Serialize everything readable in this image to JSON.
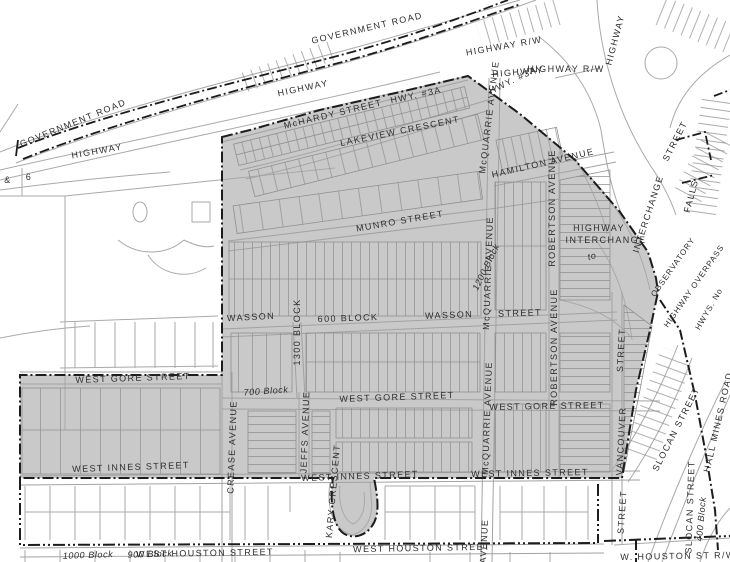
{
  "map": {
    "colors": {
      "background": "#ffffff",
      "zone_fill": "#c9c9c9",
      "boundary_line": "#1c1c1c",
      "road_line": "#a9a9a9",
      "parcel_line": "#8f8f8f",
      "label_text": "#2e2e2e"
    },
    "labels": {
      "government_road": "GOVERNMENT ROAD",
      "highway": "HIGHWAY",
      "highway_rw": "HIGHWAY  R/W",
      "hwy_3a": "HWY.  #3A",
      "ampersand": "&",
      "six": "6",
      "mchardy_street": "McHARDY STREET",
      "lakeview_crescent": "LAKEVIEW  CRESCENT",
      "hamilton_avenue": "HAMILTON  AVENUE",
      "munro_street": "MUNRO   STREET",
      "mcquarrie_avenue": "McQUARRIE  AVENUE",
      "avenue": "AVENUE",
      "robertson_avenue": "ROBERTSON  AVENUE",
      "vancouver": "VANCOUVER",
      "street": "STREET",
      "wasson": "WASSON",
      "block_600": "600  BLOCK",
      "block_1300": "1300  BLOCK",
      "block_1200": "1200 Block",
      "block_700": "700  Block",
      "block_1000": "1000  Block",
      "block_900": "900 Block",
      "block_400": "400 Block",
      "west_gore_street": "WEST  GORE  STREET",
      "west_innes_street": "WEST  INNES  STREET",
      "west_houston_street": "WEST  HOUSTON  STREET",
      "w_houston_st_rw": "W.  HOUSTON ST R/W",
      "crease_avenue": "CREASE  AVENUE",
      "jeffs_avenue": "JEFFS  AVENUE",
      "kary_crescent": "KARY CRESCENT",
      "slocan_street": "SLOCAN  STREET",
      "hall_mines_road": "HALL  MINES  ROAD",
      "falls": "FALLS",
      "interchange": "INTERCHANGE",
      "to": "to",
      "observatory": "OBSERVATORY",
      "highway_overpass": "HIGHWAY OVERPASS",
      "hwys_no": "HWYS.  No"
    }
  }
}
